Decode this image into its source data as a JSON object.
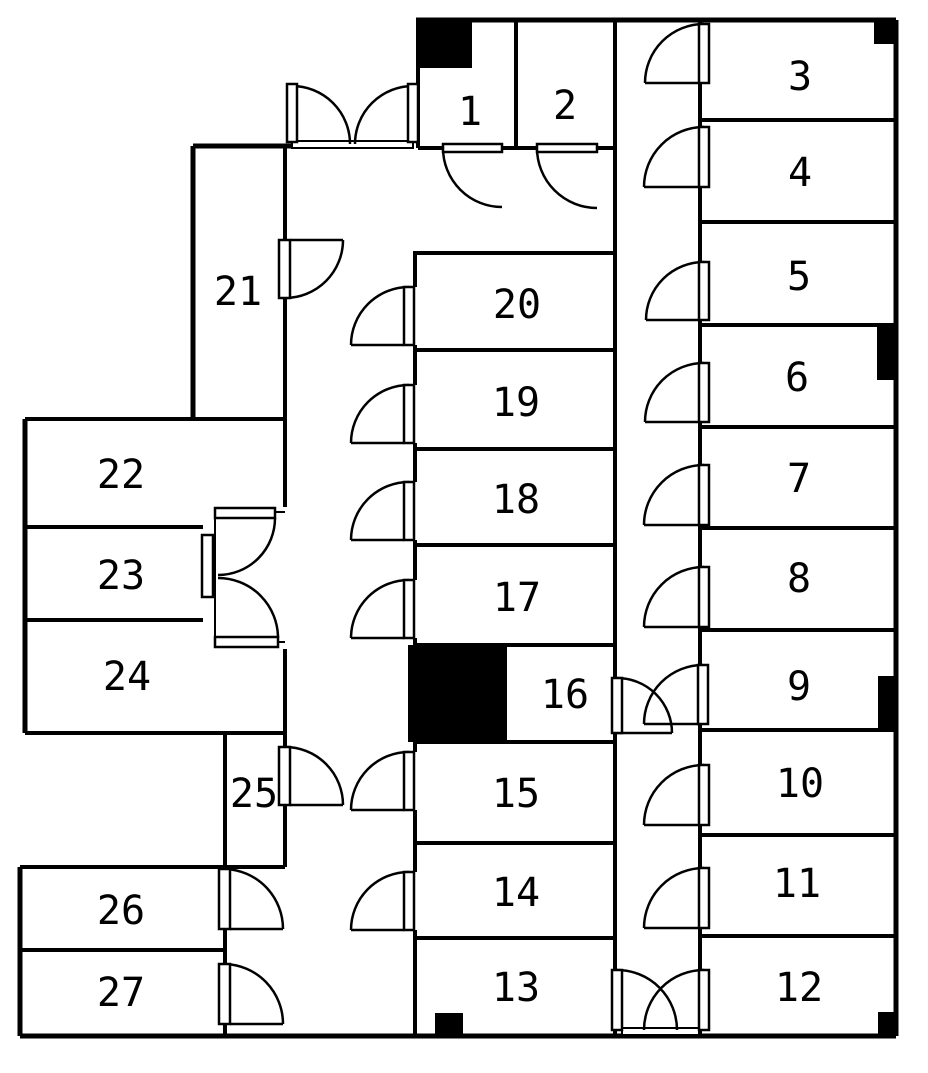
{
  "figure": {
    "kind": "architectural-floor-plan",
    "background": "#ffffff",
    "line_color": "#000000",
    "canvas": {
      "width": 928,
      "height": 1068
    }
  },
  "rooms": [
    {
      "number": "1",
      "cx": 470,
      "cy": 112
    },
    {
      "number": "2",
      "cx": 565,
      "cy": 106
    },
    {
      "number": "3",
      "cx": 800,
      "cy": 77
    },
    {
      "number": "4",
      "cx": 800,
      "cy": 173
    },
    {
      "number": "5",
      "cx": 799,
      "cy": 277
    },
    {
      "number": "6",
      "cx": 797,
      "cy": 378
    },
    {
      "number": "7",
      "cx": 799,
      "cy": 479
    },
    {
      "number": "8",
      "cx": 799,
      "cy": 579
    },
    {
      "number": "9",
      "cx": 799,
      "cy": 687
    },
    {
      "number": "10",
      "cx": 800,
      "cy": 784
    },
    {
      "number": "11",
      "cx": 797,
      "cy": 884
    },
    {
      "number": "12",
      "cx": 799,
      "cy": 988
    },
    {
      "number": "13",
      "cx": 516,
      "cy": 988
    },
    {
      "number": "14",
      "cx": 516,
      "cy": 893
    },
    {
      "number": "15",
      "cx": 516,
      "cy": 794
    },
    {
      "number": "16",
      "cx": 565,
      "cy": 695
    },
    {
      "number": "17",
      "cx": 517,
      "cy": 598
    },
    {
      "number": "18",
      "cx": 516,
      "cy": 500
    },
    {
      "number": "19",
      "cx": 516,
      "cy": 403
    },
    {
      "number": "20",
      "cx": 517,
      "cy": 305
    },
    {
      "number": "21",
      "cx": 238,
      "cy": 292
    },
    {
      "number": "22",
      "cx": 121,
      "cy": 475
    },
    {
      "number": "23",
      "cx": 121,
      "cy": 576
    },
    {
      "number": "24",
      "cx": 127,
      "cy": 677
    },
    {
      "number": "25",
      "cx": 254,
      "cy": 794
    },
    {
      "number": "26",
      "cx": 121,
      "cy": 911
    },
    {
      "number": "27",
      "cx": 121,
      "cy": 993
    }
  ],
  "walls": [
    [
      416,
      20,
      896,
      20,
      5
    ],
    [
      896,
      20,
      896,
      1036,
      5
    ],
    [
      20,
      1036,
      896,
      1036,
      5
    ],
    [
      193,
      146,
      292,
      146,
      5
    ],
    [
      193,
      146,
      193,
      419,
      5
    ],
    [
      25,
      419,
      285,
      419,
      4
    ],
    [
      25,
      419,
      25,
      733,
      5
    ],
    [
      25,
      733,
      285,
      733,
      4
    ],
    [
      20,
      867,
      285,
      867,
      4
    ],
    [
      20,
      867,
      20,
      1036,
      5
    ],
    [
      225,
      733,
      225,
      869,
      4
    ],
    [
      225,
      929,
      225,
      964,
      4
    ],
    [
      225,
      1024,
      225,
      1036,
      4
    ],
    [
      418,
      20,
      418,
      148,
      4
    ],
    [
      516,
      20,
      516,
      148,
      4
    ],
    [
      418,
      148,
      443,
      148,
      4
    ],
    [
      502,
      148,
      537,
      148,
      4
    ],
    [
      597,
      148,
      615,
      148,
      4
    ],
    [
      615,
      20,
      615,
      678,
      4
    ],
    [
      615,
      733,
      615,
      970,
      4
    ],
    [
      615,
      1030,
      615,
      1036,
      4
    ],
    [
      700,
      20,
      700,
      24,
      4
    ],
    [
      700,
      83,
      700,
      127,
      4
    ],
    [
      700,
      187,
      700,
      262,
      4
    ],
    [
      700,
      320,
      700,
      363,
      4
    ],
    [
      700,
      422,
      700,
      465,
      4
    ],
    [
      700,
      525,
      700,
      567,
      4
    ],
    [
      700,
      627,
      700,
      665,
      4
    ],
    [
      700,
      724,
      700,
      765,
      4
    ],
    [
      700,
      825,
      700,
      868,
      4
    ],
    [
      700,
      928,
      700,
      970,
      4
    ],
    [
      700,
      1030,
      700,
      1036,
      4
    ],
    [
      700,
      120,
      896,
      120,
      4
    ],
    [
      700,
      222,
      896,
      222,
      4
    ],
    [
      700,
      325,
      896,
      325,
      4
    ],
    [
      700,
      427,
      896,
      427,
      4
    ],
    [
      700,
      528,
      896,
      528,
      4
    ],
    [
      700,
      630,
      896,
      630,
      4
    ],
    [
      700,
      730,
      896,
      730,
      4
    ],
    [
      700,
      835,
      896,
      835,
      4
    ],
    [
      700,
      936,
      896,
      936,
      4
    ],
    [
      413,
      253,
      615,
      253,
      4
    ],
    [
      415,
      350,
      615,
      350,
      4
    ],
    [
      415,
      449,
      615,
      449,
      4
    ],
    [
      415,
      545,
      615,
      545,
      4
    ],
    [
      415,
      645,
      615,
      645,
      4
    ],
    [
      415,
      742,
      615,
      742,
      4
    ],
    [
      415,
      843,
      615,
      843,
      4
    ],
    [
      415,
      938,
      615,
      938,
      4
    ],
    [
      505,
      645,
      505,
      742,
      4
    ],
    [
      415,
      253,
      415,
      287,
      4
    ],
    [
      415,
      345,
      415,
      385,
      4
    ],
    [
      415,
      443,
      415,
      482,
      4
    ],
    [
      415,
      540,
      415,
      580,
      4
    ],
    [
      415,
      638,
      415,
      752,
      4
    ],
    [
      415,
      810,
      415,
      872,
      4
    ],
    [
      415,
      930,
      415,
      1036,
      4
    ],
    [
      285,
      146,
      285,
      240,
      4
    ],
    [
      285,
      298,
      285,
      507,
      4
    ],
    [
      285,
      649,
      285,
      747,
      4
    ],
    [
      285,
      805,
      285,
      867,
      4
    ],
    [
      25,
      527,
      203,
      527,
      4
    ],
    [
      25,
      620,
      203,
      620,
      4
    ],
    [
      20,
      950,
      225,
      950,
      4
    ],
    [
      215,
      513,
      215,
      640,
      2
    ],
    [
      273,
      512,
      285,
      512,
      2
    ],
    [
      276,
      642,
      285,
      642,
      2
    ]
  ],
  "door_leaves": [
    [
      287,
      84,
      10,
      58
    ],
    [
      408,
      84,
      10,
      58
    ],
    [
      443,
      144,
      59,
      8
    ],
    [
      537,
      144,
      60,
      8
    ],
    [
      699,
      24,
      10,
      59
    ],
    [
      699,
      127,
      10,
      60
    ],
    [
      699,
      262,
      10,
      58
    ],
    [
      699,
      363,
      10,
      59
    ],
    [
      699,
      465,
      10,
      60
    ],
    [
      699,
      567,
      10,
      60
    ],
    [
      698,
      665,
      10,
      59
    ],
    [
      699,
      765,
      10,
      60
    ],
    [
      699,
      868,
      10,
      60
    ],
    [
      612,
      970,
      10,
      60
    ],
    [
      699,
      970,
      10,
      60
    ],
    [
      612,
      678,
      10,
      55
    ],
    [
      404,
      287,
      10,
      58
    ],
    [
      404,
      385,
      10,
      58
    ],
    [
      404,
      482,
      10,
      58
    ],
    [
      404,
      580,
      10,
      58
    ],
    [
      404,
      752,
      10,
      58
    ],
    [
      404,
      872,
      10,
      58
    ],
    [
      279,
      240,
      11,
      58
    ],
    [
      279,
      747,
      11,
      58
    ],
    [
      219,
      869,
      11,
      60
    ],
    [
      219,
      964,
      11,
      60
    ],
    [
      215,
      508,
      60,
      10
    ],
    [
      215,
      637,
      63,
      10
    ],
    [
      202,
      535,
      11,
      62
    ]
  ],
  "door_arcs": [
    "M 292 86 A 58 58 0 0 1 350 144",
    "M 413 86 A 58 58 0 0 0 355 144",
    "M 443 148 A 59 59 0 0 0 502 207",
    "M 537 148 A 60 60 0 0 0 597 208",
    "M 704 24 A 59 59 0 0 0 645 83",
    "M 704 127 A 60 60 0 0 0 644 187",
    "M 704 262 A 58 58 0 0 0 646 320",
    "M 704 363 A 59 59 0 0 0 645 422",
    "M 704 465 A 60 60 0 0 0 644 525",
    "M 704 567 A 60 60 0 0 0 644 627",
    "M 703 665 A 59 59 0 0 0 644 724",
    "M 704 765 A 60 60 0 0 0 644 825",
    "M 704 868 A 60 60 0 0 0 644 928",
    "M 617 970 A 60 60 0 0 1 677 1030",
    "M 704 970 A 60 60 0 0 0 644 1030",
    "M 617 678 A 55 55 0 0 1 672 733",
    "M 409 287 A 58 58 0 0 0 351 345",
    "M 409 385 A 58 58 0 0 0 351 443",
    "M 409 482 A 58 58 0 0 0 351 540",
    "M 409 580 A 58 58 0 0 0 351 638",
    "M 409 752 A 58 58 0 0 0 351 810",
    "M 409 872 A 58 58 0 0 0 351 930",
    "M 343 240 A 58 58 0 0 1 285 298",
    "M 285 747 A 58 58 0 0 1 343 805",
    "M 225 869 A 60 60 0 0 1 283 929",
    "M 225 964 A 60 60 0 0 1 283 1024",
    "M 275 518 A 57 57 0 0 1 218 575",
    "M 218 578 A 60 60 0 0 1 278 638"
  ],
  "door_bases": [
    [
      645,
      83,
      699,
      83
    ],
    [
      644,
      187,
      699,
      187
    ],
    [
      646,
      320,
      699,
      320
    ],
    [
      645,
      422,
      699,
      422
    ],
    [
      644,
      525,
      699,
      525
    ],
    [
      644,
      627,
      699,
      627
    ],
    [
      644,
      724,
      698,
      724
    ],
    [
      644,
      825,
      699,
      825
    ],
    [
      644,
      928,
      699,
      928
    ],
    [
      617,
      733,
      672,
      733
    ],
    [
      351,
      345,
      404,
      345
    ],
    [
      351,
      443,
      404,
      443
    ],
    [
      351,
      540,
      404,
      540
    ],
    [
      351,
      638,
      404,
      638
    ],
    [
      351,
      810,
      404,
      810
    ],
    [
      351,
      930,
      404,
      930
    ],
    [
      290,
      240,
      343,
      240
    ],
    [
      290,
      805,
      343,
      805
    ],
    [
      230,
      929,
      283,
      929
    ],
    [
      230,
      1024,
      283,
      1024
    ]
  ],
  "thresholds": [
    [
      292,
      141,
      121,
      7
    ],
    [
      622,
      1028,
      77,
      7
    ]
  ],
  "black_marks": [
    [
      418,
      20,
      54,
      48
    ],
    [
      874,
      20,
      22,
      24
    ],
    [
      877,
      327,
      19,
      53
    ],
    [
      878,
      676,
      18,
      54
    ],
    [
      408,
      645,
      97,
      97
    ],
    [
      435,
      1013,
      28,
      23
    ],
    [
      878,
      1012,
      18,
      24
    ]
  ]
}
